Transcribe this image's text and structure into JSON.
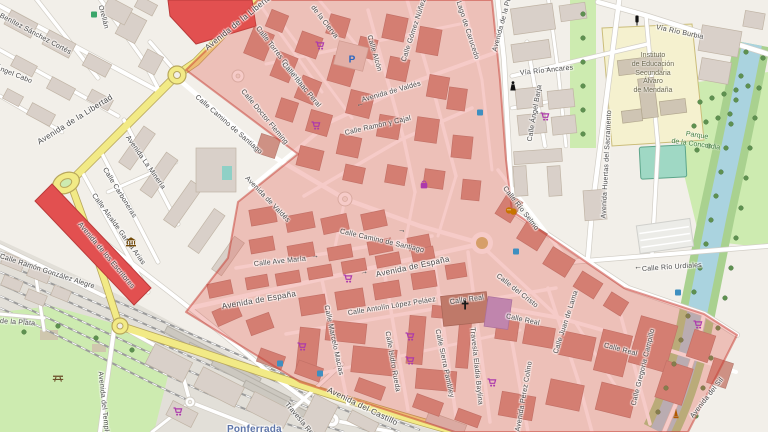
{
  "map": {
    "style": "openstreetmap-carto",
    "town_station_label": "Ponferrada",
    "colors": {
      "land": "#f2efe9",
      "water": "#aad3df",
      "park_green": "#cdebb0",
      "road_yellow": "#f2ea86",
      "road_yellow_casing": "#b8a75c",
      "road_casing": "#d2cec6",
      "building": "#d9d0c9",
      "building_zone": "#ce9184",
      "building_red": "#e25050",
      "zone_overlay_fill": "rgba(224,82,72,0.30)",
      "zone_overlay_stroke": "rgba(197,58,48,0.5)",
      "shop_magenta": "#ac39ac",
      "poi_brown": "#734a08",
      "station_blue": "#5d74a8",
      "parking_blue": "#2a66c0",
      "tree_green": "#5e9150",
      "label_gray": "#4a4a4a"
    },
    "street_labels": [
      {
        "text": "Benítez Sánchez Cortés",
        "x": 0,
        "y": 12,
        "rot": 28
      },
      {
        "text": "Ángel Cabo",
        "x": -4,
        "y": 64,
        "rot": 22
      },
      {
        "text": "Orellán",
        "x": 100,
        "y": 2,
        "rot": 75
      },
      {
        "text": "Avenida de la Libertad",
        "x": 38,
        "y": 138,
        "rot": -32,
        "cls": "lg"
      },
      {
        "text": "Avenida de la Libertad",
        "x": 206,
        "y": 44,
        "rot": -39,
        "cls": "lg"
      },
      {
        "text": "Avenida La Minería",
        "x": 127,
        "y": 133,
        "rot": 55
      },
      {
        "text": "Calle Carboneras",
        "x": 104,
        "y": 165,
        "rot": 58
      },
      {
        "text": "Calle Alcalde García Arias",
        "x": 93,
        "y": 191,
        "rot": 54
      },
      {
        "text": "Avenida de los Escritores",
        "x": 79,
        "y": 220,
        "rot": 50
      },
      {
        "text": "Calle Ramón González Alegre",
        "x": 0,
        "y": 253,
        "rot": 18
      },
      {
        "text": "de la Plata",
        "x": 0,
        "y": 318,
        "rot": 4
      },
      {
        "text": "Avenida del Temple",
        "x": 100,
        "y": 368,
        "rot": 84
      },
      {
        "text": "Travesía Reyes",
        "x": 286,
        "y": 400,
        "rot": 50
      },
      {
        "text": "Avenida del Castillo",
        "x": 328,
        "y": 385,
        "rot": 26,
        "cls": "lg"
      },
      {
        "text": "Calle Torres Quevedo",
        "x": 257,
        "y": 24,
        "rot": 52
      },
      {
        "text": "de la Cierva",
        "x": 312,
        "y": 3,
        "rot": 52
      },
      {
        "text": "Calle Isaac Peral",
        "x": 283,
        "y": 60,
        "rot": 50
      },
      {
        "text": "Calle Doctor Fleming",
        "x": 242,
        "y": 87,
        "rot": 50
      },
      {
        "text": "Calle Alcón",
        "x": 369,
        "y": 32,
        "rot": 74
      },
      {
        "text": "Calle Gómez Núñez",
        "x": 404,
        "y": 58,
        "rot": -72
      },
      {
        "text": "Lago de Carucedo",
        "x": 458,
        "y": -2,
        "rot": 72
      },
      {
        "text": "Avenida de la Puebla",
        "x": 495,
        "y": 48,
        "rot": -75
      },
      {
        "text": "Avenida de Valdés",
        "x": 362,
        "y": 97,
        "rot": -16
      },
      {
        "text": "Avenida de Valdés",
        "x": 246,
        "y": 174,
        "rot": 46
      },
      {
        "text": "Calle Ramón y Cajal",
        "x": 345,
        "y": 130,
        "rot": -13
      },
      {
        "text": "Calle Camino de Santiago",
        "x": 196,
        "y": 93,
        "rot": 41
      },
      {
        "text": "Calle Camino de Santiago",
        "x": 340,
        "y": 228,
        "rot": 13
      },
      {
        "text": "Calle Ave María",
        "x": 254,
        "y": 261,
        "rot": -6
      },
      {
        "text": "Avenida de España",
        "x": 222,
        "y": 302,
        "rot": -10,
        "cls": "lg"
      },
      {
        "text": "Avenida de España",
        "x": 376,
        "y": 270,
        "rot": -12,
        "cls": "lg"
      },
      {
        "text": "Calle Antolín López Peláez",
        "x": 348,
        "y": 310,
        "rot": -9
      },
      {
        "text": "Calle Marcelo Macías",
        "x": 326,
        "y": 302,
        "rot": 78
      },
      {
        "text": "Calle Isidro Rueda",
        "x": 387,
        "y": 328,
        "rot": 80
      },
      {
        "text": "Calle Sierra Pambley",
        "x": 437,
        "y": 326,
        "rot": 78
      },
      {
        "text": "Travesía Eladia Baylina",
        "x": 472,
        "y": 324,
        "rot": 84
      },
      {
        "text": "Calle Real",
        "x": 450,
        "y": 299,
        "rot": -8
      },
      {
        "text": "Calle Real",
        "x": 506,
        "y": 313,
        "rot": 12
      },
      {
        "text": "Calle Real",
        "x": 604,
        "y": 342,
        "rot": 15
      },
      {
        "text": "Calle del Cristo",
        "x": 497,
        "y": 272,
        "rot": 38
      },
      {
        "text": "Calle Juan de Lama",
        "x": 556,
        "y": 350,
        "rot": -72
      },
      {
        "text": "Avenida Pérez Colino",
        "x": 518,
        "y": 428,
        "rot": -80
      },
      {
        "text": "Calle Gregoria Campillo",
        "x": 634,
        "y": 402,
        "rot": -76
      },
      {
        "text": "Avenida del Sil",
        "x": 692,
        "y": 414,
        "rot": -52
      },
      {
        "text": "Vía Río Burbia",
        "x": 656,
        "y": 24,
        "rot": 12
      },
      {
        "text": "Vía Río Ancares",
        "x": 520,
        "y": 70,
        "rot": -6
      },
      {
        "text": "Calle Ángel Barja",
        "x": 530,
        "y": 138,
        "rot": -80
      },
      {
        "text": "Avenida Huertas del Sacramento",
        "x": 604,
        "y": 215,
        "rot": -87
      },
      {
        "text": "Calle Río Selmo",
        "x": 504,
        "y": 184,
        "rot": 52
      },
      {
        "text": "Calle Río Urdiales",
        "x": 642,
        "y": 266,
        "rot": -4
      }
    ],
    "area_labels": {
      "school": {
        "lines": [
          "Instituto",
          "de Educación",
          "Secundaria",
          "Álvaro",
          "de Mendaña"
        ],
        "x": 610,
        "y": 52,
        "w": 86
      },
      "park": {
        "lines": [
          "Parque",
          "de la Concordia"
        ],
        "x": 660,
        "y": 126,
        "w": 76,
        "rot": 8
      },
      "station": {
        "text": "Ponferrada",
        "x": 227,
        "y": 424
      }
    },
    "icons": [
      {
        "name": "supermarket-icon",
        "type": "cart",
        "x": 320,
        "y": 47
      },
      {
        "name": "supermarket-icon",
        "type": "cart",
        "x": 316,
        "y": 127
      },
      {
        "name": "supermarket-icon",
        "type": "cart",
        "x": 545,
        "y": 118
      },
      {
        "name": "supermarket-icon",
        "type": "cart",
        "x": 348,
        "y": 280
      },
      {
        "name": "supermarket-icon",
        "type": "cart",
        "x": 302,
        "y": 348
      },
      {
        "name": "supermarket-icon",
        "type": "cart",
        "x": 410,
        "y": 338
      },
      {
        "name": "supermarket-icon",
        "type": "cart",
        "x": 410,
        "y": 362
      },
      {
        "name": "supermarket-icon",
        "type": "cart",
        "x": 492,
        "y": 384
      },
      {
        "name": "supermarket-icon",
        "type": "cart",
        "x": 178,
        "y": 413
      },
      {
        "name": "supermarket-icon",
        "type": "cart",
        "x": 698,
        "y": 326
      },
      {
        "name": "clothes-shop-icon",
        "type": "bag",
        "x": 424,
        "y": 186
      },
      {
        "name": "parking-icon",
        "type": "parking",
        "x": 352,
        "y": 60
      },
      {
        "name": "museum-icon",
        "type": "museum",
        "x": 131,
        "y": 243
      },
      {
        "name": "statue-icon",
        "type": "statue",
        "x": 513,
        "y": 87
      },
      {
        "name": "theatre-icon",
        "type": "theatre",
        "x": 511,
        "y": 212
      },
      {
        "name": "church-cross-icon",
        "type": "church",
        "x": 465,
        "y": 306
      },
      {
        "name": "monument-icon",
        "type": "monument",
        "x": 676,
        "y": 415
      },
      {
        "name": "picnic-icon",
        "type": "picnic",
        "x": 58,
        "y": 378
      },
      {
        "name": "poi-blue-icon",
        "type": "bluebox",
        "x": 516,
        "y": 251
      },
      {
        "name": "poi-blue-icon",
        "type": "bluebox",
        "x": 678,
        "y": 292
      },
      {
        "name": "poi-blue-icon",
        "type": "bluebox",
        "x": 280,
        "y": 363
      },
      {
        "name": "poi-blue-icon",
        "type": "bluebox",
        "x": 320,
        "y": 373
      },
      {
        "name": "poi-blue-icon",
        "type": "bluebox",
        "x": 480,
        "y": 112
      },
      {
        "name": "recycling-icon",
        "type": "greenbox",
        "x": 94,
        "y": 14
      },
      {
        "name": "traffic-light-icon",
        "type": "traffic",
        "x": 637,
        "y": 22
      }
    ],
    "oneway_arrows": [
      {
        "glyph": "→",
        "x": 311,
        "y": 251,
        "rot": -6
      },
      {
        "glyph": "→",
        "x": 360,
        "y": 267,
        "rot": -11
      },
      {
        "glyph": "→",
        "x": 543,
        "y": 63,
        "rot": -4
      },
      {
        "glyph": "←",
        "x": 634,
        "y": 262,
        "rot": -3
      },
      {
        "glyph": "←",
        "x": 356,
        "y": 99,
        "rot": -16
      },
      {
        "glyph": "→",
        "x": 398,
        "y": 225,
        "rot": 12
      }
    ]
  }
}
